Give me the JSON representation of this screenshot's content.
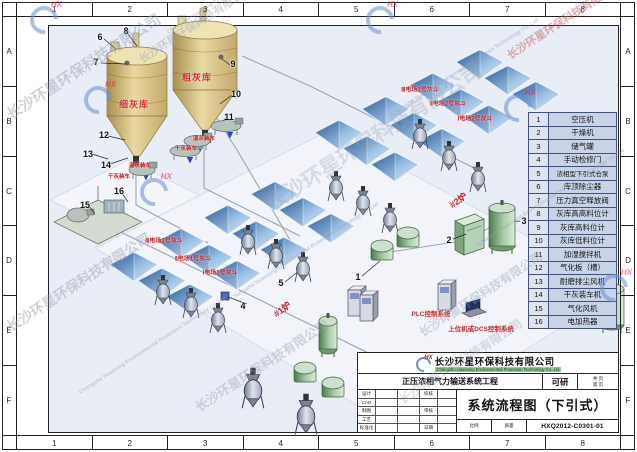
{
  "frame": {
    "cols": [
      "1",
      "2",
      "3",
      "4",
      "5",
      "6",
      "7",
      "8"
    ],
    "rows": [
      "A",
      "B",
      "C",
      "D",
      "E",
      "F"
    ]
  },
  "legend": {
    "rows": [
      {
        "num": "1",
        "name": "空压机"
      },
      {
        "num": "2",
        "name": "干燥机"
      },
      {
        "num": "3",
        "name": "储气罐"
      },
      {
        "num": "4",
        "name": "手动检修门"
      },
      {
        "num": "5",
        "name": "浓相型下引式仓泵"
      },
      {
        "num": "6",
        "name": "库顶除尘器"
      },
      {
        "num": "7",
        "name": "压力真空释放阀"
      },
      {
        "num": "8",
        "name": "灰库高高料位计"
      },
      {
        "num": "9",
        "name": "灰库高料位计"
      },
      {
        "num": "10",
        "name": "灰库低料位计"
      },
      {
        "num": "11",
        "name": "加湿搅拌机"
      },
      {
        "num": "12",
        "name": "气化板（槽）"
      },
      {
        "num": "13",
        "name": "耐磨排尘风机"
      },
      {
        "num": "14",
        "name": "干灰装车机"
      },
      {
        "num": "15",
        "name": "气化风机"
      },
      {
        "num": "16",
        "name": "电加热器"
      }
    ]
  },
  "diagram": {
    "silo_fine": "细灰库",
    "silo_coarse": "粗灰库",
    "wet_loading": "湿灰装车",
    "dry_loading": "干灰装车",
    "boiler1": "#1炉",
    "boiler2": "#2炉",
    "esp1": [
      "Ⅲ电场1号灰斗",
      "Ⅱ电场1号灰斗",
      "Ⅰ电场1号灰斗"
    ],
    "esp2": [
      "Ⅲ电场2号灰斗",
      "Ⅱ电场2号灰斗",
      "Ⅰ电场2号灰斗"
    ],
    "plc": "PLC控制系统",
    "dcs": "上位机或DCS控制系统",
    "callouts": [
      "1",
      "2",
      "3",
      "4",
      "5",
      "6",
      "7",
      "8",
      "9",
      "10",
      "11",
      "12",
      "13",
      "14",
      "15",
      "16"
    ]
  },
  "title_block": {
    "company_cn": "长沙环星环保科技有限公司",
    "company_en": "Changsha Huanxing Environmental Protection Technology Co.,Ltd",
    "logo_text": "HX",
    "project": "正压浓相气力输送系统工程",
    "stage": "可研",
    "pages_total": "共  页",
    "page_no": "第  页",
    "drawing_title": "系统流程图（下引式）",
    "drawing_no": "HXQ2012-C0301-01",
    "rows_left": [
      "设计",
      "CAD",
      "制图",
      "工艺",
      "标准化"
    ],
    "rows_mid": [
      "校核",
      "审核",
      "日期"
    ],
    "scale_label": "比例",
    "weight_label": "质量"
  },
  "watermark": {
    "cn": "长沙环星环保科技有限公司",
    "en": "Changsha Huanxing Environmental Protection Technology Co.,Ltd",
    "logo": "HX"
  },
  "colors": {
    "sheet_bg": "#e9edf6",
    "accent_red": "#cc2222",
    "panel_blue": "#2e63a4",
    "silo_tan": "#e0cf96",
    "equip_green": "#7fae7f",
    "legend_cell": "#c9d3e8"
  }
}
